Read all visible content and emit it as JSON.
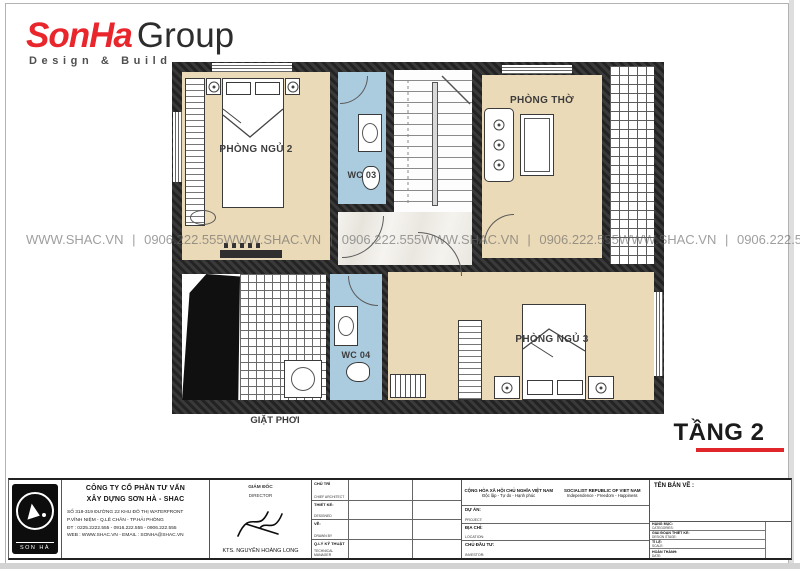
{
  "header": {
    "logo": {
      "brand": "SonHa",
      "suffix": "Group",
      "tagline": "Design & Build"
    }
  },
  "watermark": {
    "text": "WWW.SHAC.VN  |  0906.222.555"
  },
  "plan": {
    "sheet_title": "TẦNG 2",
    "labels": {
      "bedroom2": "PHÒNG NGỦ 2",
      "wc03": "WC 03",
      "worship": "PHÒNG THỜ",
      "wc04": "WC 04",
      "bedroom3": "PHÒNG NGỦ 3",
      "laundry": "GIẶT PHƠI"
    },
    "colors": {
      "floor_beige": "#ebdab8",
      "floor_wc": "#abcbdf",
      "wall": "#262626",
      "accent_red": "#e0262a"
    }
  },
  "title_block": {
    "company": {
      "name_line1": "CÔNG TY CỔ PHẦN TƯ VẤN",
      "name_line2": "XÂY DỰNG SƠN HÀ - SHAC",
      "address_line1": "SỐ 318-319 ĐƯỜNG 22 KHU ĐÔ THỊ WATERFRONT",
      "address_line2": "P.VĨNH NIỆM - Q.LÊ CHÂN - TP.HẢI PHÒNG",
      "address_line3": "ĐT : 0225.2222.555 - 0916.222.555 - 0906.222.555",
      "address_line4": "WEB : WWW.SHAC.VN - EMAIL : SONHA@SHAC.VN",
      "logo_text": "SON HÀ"
    },
    "director": {
      "vi": "GIÁM ĐỐC",
      "en": "DIRECTOR",
      "architect": "KTS. NGUYỄN HOÀNG LONG"
    },
    "roles": [
      {
        "vi": "CHỦ TRÌ",
        "en": "CHIEF ARCHITECT"
      },
      {
        "vi": "THIẾT KẾ:",
        "en": "DESIGNED"
      },
      {
        "vi": "VẼ:",
        "en": "DRAWN BY"
      },
      {
        "vi": "Q.LÝ KỸ THUẬT",
        "en": "TECHNICAL MANAGER"
      }
    ],
    "republic": {
      "vi1": "CỘNG HÒA XÃ HỘI CHỦ NGHĨA VIỆT NAM",
      "vi2": "Độc lập - Tự do - Hạnh phúc",
      "en1": "SOCIALIST REPUBLIC OF VIET NAM",
      "en2": "Independence - Freedom - Happiness"
    },
    "project": {
      "vi": "DỰ ÁN:",
      "en": "PROJECT:"
    },
    "location": {
      "vi": "ĐỊA CHỈ:",
      "en": "LOCATION:"
    },
    "investor": {
      "vi": "CHỦ ĐẦU TƯ:",
      "en": "INVESTOR:"
    },
    "drawing_name_label": "TÊN BẢN VẼ :",
    "fields": [
      {
        "vi": "HẠNG MỤC:",
        "en": "CATEGORIES:"
      },
      {
        "vi": "GIAI ĐOẠN THIẾT KẾ:",
        "en": "DESIGN STAGE:"
      },
      {
        "vi": "TỈ LỆ:",
        "en": "SCALE:"
      },
      {
        "vi": "HOÀN THÀNH:",
        "en": "DATE:"
      }
    ]
  }
}
